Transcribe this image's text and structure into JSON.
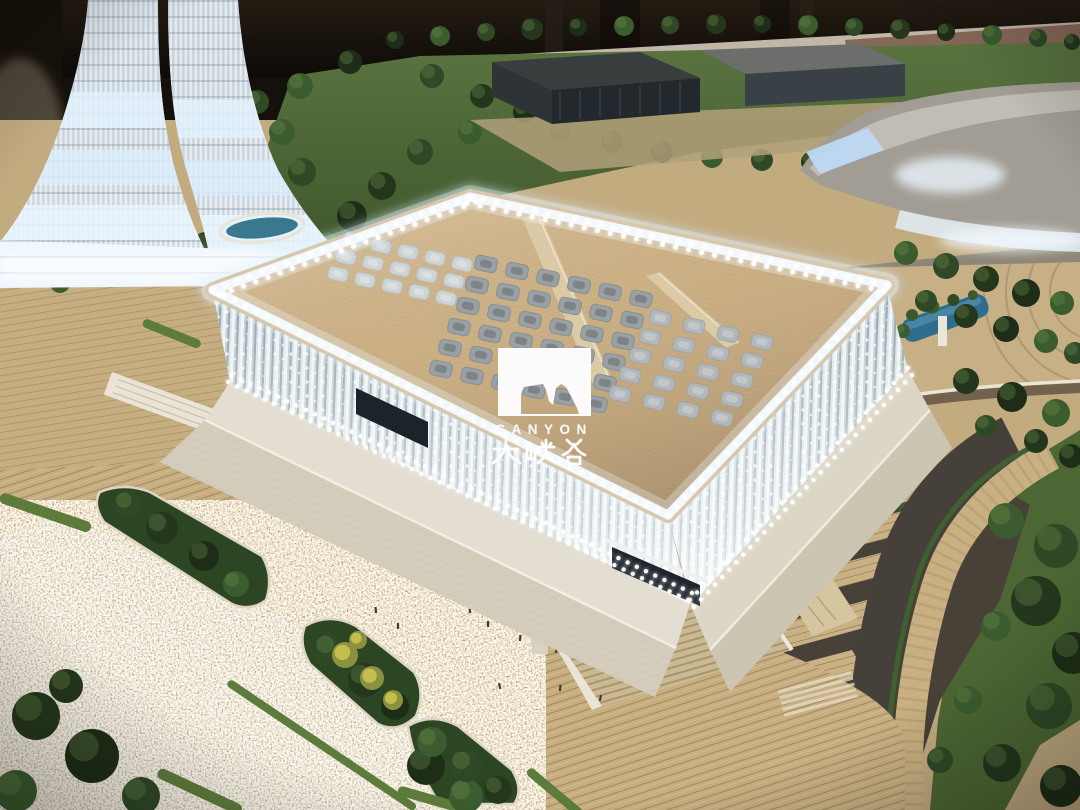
{
  "watermark": {
    "brand_en": "CANYON",
    "brand_zh": "大峡谷",
    "color": "#ffffff"
  },
  "palette": {
    "backdrop": "#1a140e",
    "roof_beige": "#cdb288",
    "roof_edge_glow": "#f3f9fd",
    "led_white": "#ffffff",
    "facade_light": "#eaf2f6",
    "facade_shadow": "#93a2a7",
    "plaza_beige": "#c3ab80",
    "asphalt": "#484136",
    "grass_green": "#4a6231",
    "tree_green": "#2b4122",
    "water_teal": "#34718f",
    "tower_glow": "#e7f2fc",
    "sparkle_ground": "#bfae92"
  },
  "scene": {
    "roof_corners": {
      "w": [
        213,
        290
      ],
      "n": [
        470,
        197
      ],
      "e": [
        887,
        285
      ],
      "s": [
        668,
        515
      ]
    },
    "led_edges": [
      {
        "p1": [
          213,
          290
        ],
        "p2": [
          470,
          197
        ],
        "spacing": 13,
        "r": 2.6,
        "rows": [
          [
            0,
            0
          ],
          [
            6,
            5
          ]
        ]
      },
      {
        "p1": [
          470,
          197
        ],
        "p2": [
          887,
          285
        ],
        "spacing": 13,
        "r": 2.6,
        "rows": [
          [
            0,
            0
          ],
          [
            -3,
            6
          ]
        ]
      },
      {
        "p1": [
          887,
          285
        ],
        "p2": [
          668,
          515
        ],
        "spacing": 12,
        "r": 2.4,
        "rows": [
          [
            0,
            0
          ]
        ]
      },
      {
        "p1": [
          668,
          515
        ],
        "p2": [
          213,
          290
        ],
        "spacing": 12,
        "r": 2.4,
        "rows": [
          [
            0,
            0
          ]
        ]
      },
      {
        "p1": [
          228,
          382
        ],
        "p2": [
          688,
          600
        ],
        "spacing": 10,
        "r": 2.2,
        "rows": [
          [
            0,
            0
          ],
          [
            4,
            -7
          ]
        ]
      },
      {
        "p1": [
          690,
          600
        ],
        "p2": [
          908,
          368
        ],
        "spacing": 10,
        "r": 2.2,
        "rows": [
          [
            0,
            0
          ],
          [
            4,
            7
          ]
        ]
      }
    ],
    "skylight_clusters": [
      {
        "name": "northwest",
        "origin": [
          354,
          240
        ],
        "col": [
          27,
          6
        ],
        "row": [
          -8,
          17
        ],
        "cols": 5,
        "rows": 3,
        "w": 20,
        "h": 13,
        "fill": "#ced3d4",
        "stroke": "#b9c0c2",
        "hl": "rgba(255,255,255,0.28)"
      },
      {
        "name": "center",
        "origin": [
          486,
          264
        ],
        "col": [
          31,
          7
        ],
        "row": [
          -9,
          21
        ],
        "cols": 6,
        "rows": 6,
        "w": 22,
        "h": 15,
        "fill": "#9aa1a4",
        "stroke": "#878e91",
        "hl": "rgba(0,0,0,0.18)"
      },
      {
        "name": "east",
        "origin": [
          660,
          318
        ],
        "col": [
          34,
          8
        ],
        "row": [
          -10,
          19
        ],
        "cols": 4,
        "rows": 5,
        "w": 21,
        "h": 14,
        "fill": "#b2b8ba",
        "stroke": "#9fa5a7",
        "hl": "rgba(255,255,255,0.22)"
      }
    ],
    "tree_colors": [
      "#24371d",
      "#2f4926",
      "#3b5c2f",
      "#1d2d17"
    ],
    "trees": [
      [
        395,
        40,
        9
      ],
      [
        440,
        36,
        10
      ],
      [
        486,
        32,
        9
      ],
      [
        532,
        29,
        11
      ],
      [
        578,
        27,
        9
      ],
      [
        624,
        26,
        10
      ],
      [
        670,
        25,
        9
      ],
      [
        716,
        24,
        10
      ],
      [
        762,
        24,
        9
      ],
      [
        808,
        25,
        10
      ],
      [
        854,
        27,
        9
      ],
      [
        900,
        29,
        10
      ],
      [
        946,
        32,
        9
      ],
      [
        992,
        35,
        10
      ],
      [
        1038,
        38,
        9
      ],
      [
        1072,
        42,
        8
      ],
      [
        350,
        62,
        12
      ],
      [
        300,
        86,
        13
      ],
      [
        432,
        76,
        12
      ],
      [
        482,
        96,
        12
      ],
      [
        524,
        112,
        11
      ],
      [
        470,
        132,
        12
      ],
      [
        420,
        152,
        13
      ],
      [
        382,
        186,
        14
      ],
      [
        352,
        216,
        15
      ],
      [
        332,
        246,
        15
      ],
      [
        302,
        172,
        14
      ],
      [
        272,
        202,
        16
      ],
      [
        252,
        232,
        17
      ],
      [
        282,
        132,
        13
      ],
      [
        257,
        102,
        12
      ],
      [
        230,
        262,
        16
      ],
      [
        206,
        247,
        15
      ],
      [
        247,
        264,
        16
      ],
      [
        286,
        271,
        14
      ],
      [
        323,
        277,
        13
      ],
      [
        24,
        273,
        11
      ],
      [
        60,
        283,
        10
      ],
      [
        560,
        130,
        11
      ],
      [
        612,
        142,
        11
      ],
      [
        662,
        152,
        11
      ],
      [
        712,
        157,
        11
      ],
      [
        762,
        160,
        11
      ],
      [
        812,
        162,
        11
      ],
      [
        862,
        166,
        11
      ],
      [
        906,
        253,
        12
      ],
      [
        946,
        266,
        13
      ],
      [
        986,
        279,
        13
      ],
      [
        1026,
        293,
        14
      ],
      [
        1062,
        303,
        12
      ],
      [
        926,
        301,
        11
      ],
      [
        966,
        316,
        12
      ],
      [
        1006,
        329,
        13
      ],
      [
        1046,
        341,
        12
      ],
      [
        1075,
        353,
        11
      ],
      [
        966,
        381,
        13
      ],
      [
        1012,
        397,
        15
      ],
      [
        1056,
        413,
        14
      ],
      [
        986,
        426,
        11
      ],
      [
        1036,
        441,
        12
      ],
      [
        1071,
        456,
        12
      ],
      [
        1006,
        521,
        18
      ],
      [
        1056,
        546,
        22
      ],
      [
        1036,
        601,
        25
      ],
      [
        1073,
        653,
        21
      ],
      [
        996,
        626,
        15
      ],
      [
        1049,
        706,
        23
      ],
      [
        1002,
        763,
        19
      ],
      [
        1061,
        786,
        21
      ],
      [
        968,
        700,
        14
      ],
      [
        940,
        760,
        13
      ],
      [
        36,
        716,
        24
      ],
      [
        92,
        756,
        27
      ],
      [
        16,
        791,
        21
      ],
      [
        141,
        796,
        19
      ],
      [
        66,
        686,
        17
      ],
      [
        426,
        766,
        19
      ],
      [
        466,
        796,
        17
      ],
      [
        128,
        505,
        14
      ],
      [
        162,
        528,
        16
      ],
      [
        204,
        556,
        15
      ],
      [
        236,
        584,
        13
      ],
      [
        330,
        650,
        16
      ],
      [
        365,
        680,
        17
      ],
      [
        395,
        706,
        14
      ],
      [
        432,
        742,
        15
      ],
      [
        466,
        766,
        16
      ],
      [
        498,
        790,
        14
      ],
      [
        880,
        316,
        8
      ],
      [
        903,
        331,
        7
      ],
      [
        861,
        301,
        7
      ]
    ],
    "yellow_bushes": [
      [
        345,
        655,
        13
      ],
      [
        372,
        678,
        12
      ],
      [
        393,
        700,
        10
      ],
      [
        358,
        640,
        9
      ]
    ],
    "hedges": [
      [
        0,
        497,
        96,
        11,
        19
      ],
      [
        228,
        682,
        226,
        8,
        34
      ],
      [
        158,
        772,
        92,
        11,
        25
      ],
      [
        398,
        790,
        72,
        10,
        16
      ],
      [
        528,
        770,
        70,
        9,
        40
      ],
      [
        143,
        322,
        62,
        9,
        22
      ]
    ],
    "people": [
      [
        452,
        598
      ],
      [
        470,
        612
      ],
      [
        488,
        626
      ],
      [
        520,
        640
      ],
      [
        556,
        652
      ],
      [
        610,
        648
      ],
      [
        650,
        635
      ],
      [
        700,
        622
      ],
      [
        420,
        575
      ],
      [
        385,
        550
      ],
      [
        330,
        520
      ],
      [
        740,
        610
      ],
      [
        780,
        598
      ],
      [
        560,
        690
      ],
      [
        600,
        700
      ],
      [
        500,
        688
      ],
      [
        376,
        612
      ],
      [
        398,
        628
      ]
    ]
  }
}
